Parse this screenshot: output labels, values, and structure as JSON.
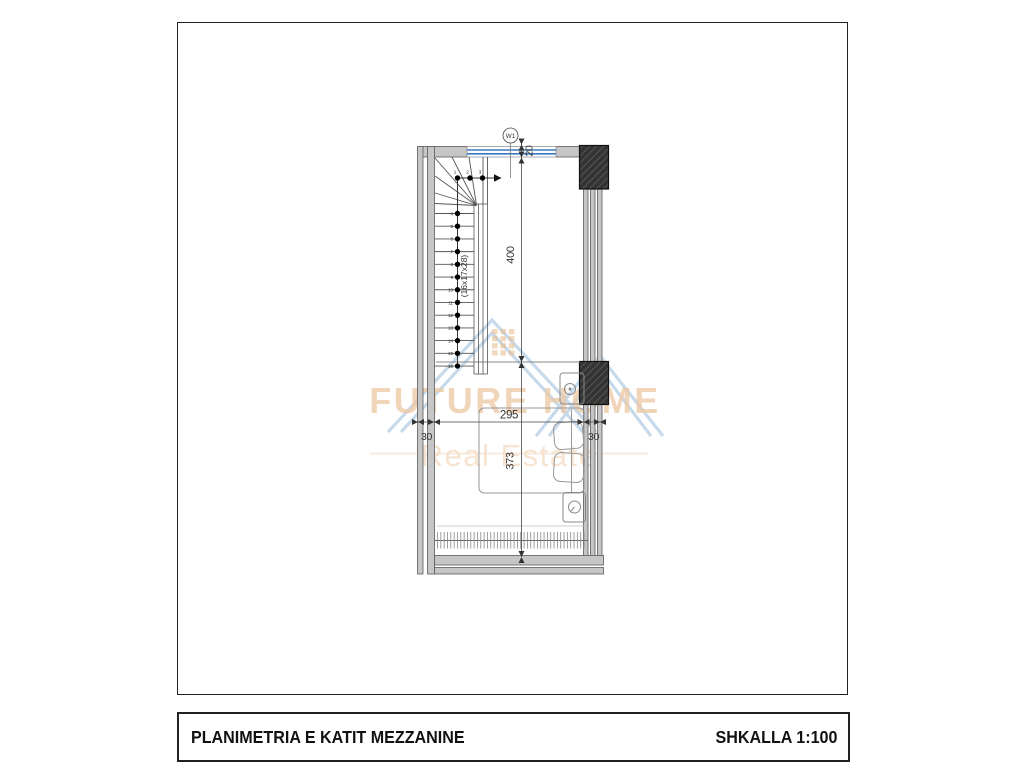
{
  "title_block": {
    "title": "PLANIMETRIA E KATIT MEZZANINE",
    "scale_label": "SHKALLA 1:100"
  },
  "watermark": {
    "brand": "FUTURE HOME",
    "tagline": "Real Estate",
    "brand_color": "#e9ba8a",
    "tagline_color": "#f2d6ba",
    "roof_color": "#a9c7e3",
    "grid_color": "#e2a668"
  },
  "plan": {
    "window_tag": "W1",
    "stair_label": "(16x17x28)",
    "stair_steps": [
      "1",
      "2",
      "3",
      "4",
      "5",
      "6",
      "7",
      "8",
      "9",
      "10",
      "11",
      "12",
      "13",
      "14",
      "15",
      "16"
    ],
    "dimensions": {
      "window_thickness": "20",
      "upper_length": "400",
      "room_width": "295",
      "left_wall": "30",
      "right_wall": "30",
      "lower_length": "373"
    },
    "colors": {
      "wall_fill": "#c6c6c6",
      "wall_edge": "#5a5a5a",
      "window_blue": "#3b79c2",
      "line": "#555555",
      "furniture": "#999999"
    }
  }
}
